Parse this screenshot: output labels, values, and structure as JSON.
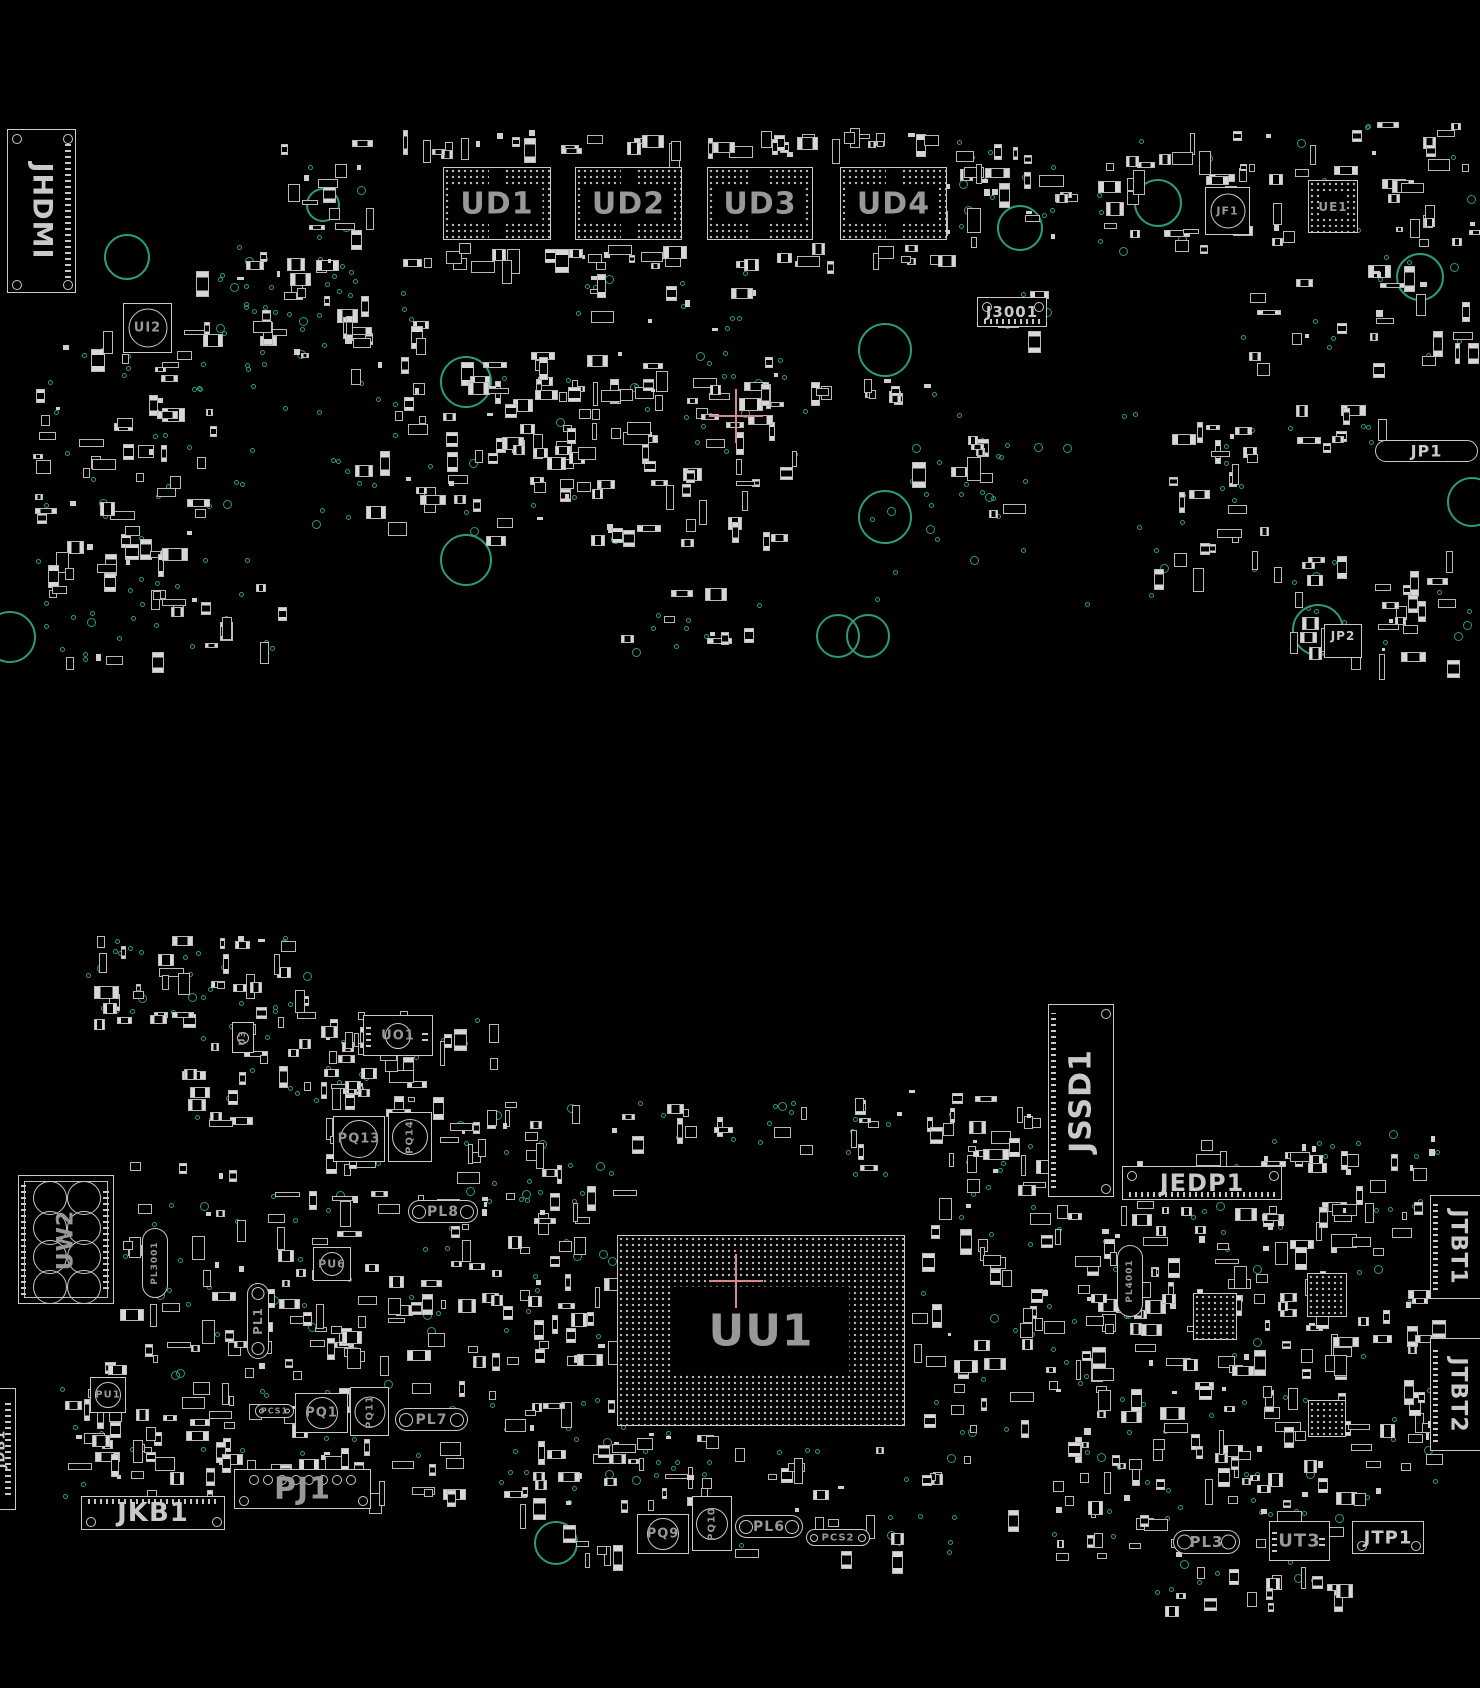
{
  "colors": {
    "background": "#000000",
    "component_outline": "#c9c9c9",
    "label_gray": "#989898",
    "label_bright": "#c9c9c9",
    "via_teal": "#2b9c78",
    "mounting_hole_teal": "#2b9c78",
    "crosshair_red": "#d48a8a",
    "bga_dot": "#b3b3b3"
  },
  "components": [
    {
      "label": "JHDMI",
      "x": 7,
      "y": 129,
      "w": 69,
      "h": 164,
      "kind": "connector",
      "rot": 90,
      "fs": 27,
      "corners": [
        "tl",
        "tr",
        "bl",
        "br"
      ],
      "pins": "right",
      "bright": true
    },
    {
      "label": "UD1",
      "x": 443,
      "y": 167,
      "w": 108,
      "h": 73,
      "kind": "bga",
      "fs": 30
    },
    {
      "label": "UD2",
      "x": 575,
      "y": 167,
      "w": 107,
      "h": 73,
      "kind": "bga",
      "fs": 30
    },
    {
      "label": "UD3",
      "x": 707,
      "y": 167,
      "w": 106,
      "h": 73,
      "kind": "bga",
      "fs": 30
    },
    {
      "label": "UD4",
      "x": 840,
      "y": 167,
      "w": 107,
      "h": 73,
      "kind": "bga",
      "fs": 30
    },
    {
      "label": "UI2",
      "x": 123,
      "y": 303,
      "w": 49,
      "h": 50,
      "kind": "chip-circle",
      "fs": 13
    },
    {
      "label": "J3001",
      "x": 977,
      "y": 297,
      "w": 70,
      "h": 30,
      "kind": "connector",
      "fs": 15,
      "corners": [
        "tl",
        "tr"
      ],
      "pins": "bottom",
      "bright": true
    },
    {
      "label": "JF1",
      "x": 1205,
      "y": 187,
      "w": 45,
      "h": 48,
      "kind": "chip-circle",
      "fs": 11
    },
    {
      "label": "UE1",
      "x": 1308,
      "y": 180,
      "w": 50,
      "h": 53,
      "kind": "bga-center",
      "fs": 12
    },
    {
      "label": "JP1",
      "x": 1375,
      "y": 440,
      "w": 103,
      "h": 22,
      "kind": "obround",
      "fs": 16,
      "pins": "both",
      "bright": true
    },
    {
      "label": "JP2",
      "x": 1324,
      "y": 624,
      "w": 38,
      "h": 34,
      "kind": "rect",
      "fs": 12,
      "bright": true
    },
    {
      "label": "JSSD1",
      "x": 1048,
      "y": 1004,
      "w": 66,
      "h": 193,
      "kind": "connector",
      "rot": -90,
      "fs": 30,
      "corners": [
        "tr",
        "br"
      ],
      "pins": "left",
      "bright": true
    },
    {
      "label": "JEDP1",
      "x": 1122,
      "y": 1166,
      "w": 160,
      "h": 34,
      "kind": "connector",
      "fs": 24,
      "corners": [
        "tl",
        "tr"
      ],
      "pins": "bottom",
      "bright": true
    },
    {
      "label": "JTBT1",
      "x": 1430,
      "y": 1195,
      "w": 56,
      "h": 104,
      "kind": "connector",
      "rot": 90,
      "fs": 22,
      "pins": "left",
      "bright": true
    },
    {
      "label": "JTBT2",
      "x": 1430,
      "y": 1338,
      "w": 56,
      "h": 113,
      "kind": "connector",
      "rot": 90,
      "fs": 22,
      "pins": "left",
      "bright": true
    },
    {
      "label": "UU1",
      "x": 617,
      "y": 1235,
      "w": 288,
      "h": 191,
      "kind": "bga-center",
      "fs": 44,
      "cw": 0.62,
      "ch": 0.47
    },
    {
      "label": "UW2",
      "x": 18,
      "y": 1175,
      "w": 96,
      "h": 129,
      "kind": "bga-coils",
      "rot": -90,
      "fs": 22
    },
    {
      "label": "UO1",
      "x": 363,
      "y": 1015,
      "w": 70,
      "h": 41,
      "kind": "chip-pads",
      "fs": 13
    },
    {
      "label": "U3",
      "x": 232,
      "y": 1022,
      "w": 22,
      "h": 31,
      "kind": "chip-circle",
      "rot": -90,
      "fs": 9
    },
    {
      "label": "PQ13",
      "x": 333,
      "y": 1116,
      "w": 52,
      "h": 46,
      "kind": "coil",
      "fs": 13
    },
    {
      "label": "PQ14",
      "x": 388,
      "y": 1112,
      "w": 44,
      "h": 50,
      "kind": "coil",
      "rot": -90,
      "fs": 10
    },
    {
      "label": "PL3001",
      "x": 142,
      "y": 1228,
      "w": 26,
      "h": 70,
      "kind": "obround",
      "rot": -90,
      "fs": 9
    },
    {
      "label": "PL4001",
      "x": 1117,
      "y": 1245,
      "w": 26,
      "h": 72,
      "kind": "obround",
      "rot": -90,
      "fs": 9
    },
    {
      "label": "PU6",
      "x": 313,
      "y": 1247,
      "w": 38,
      "h": 34,
      "kind": "chip-circle",
      "fs": 11
    },
    {
      "label": "PL8",
      "x": 408,
      "y": 1200,
      "w": 70,
      "h": 23,
      "kind": "obround",
      "fs": 14,
      "endcircles": true
    },
    {
      "label": "PL1",
      "x": 247,
      "y": 1283,
      "w": 22,
      "h": 76,
      "kind": "obround",
      "rot": -90,
      "fs": 12,
      "endcircles": true
    },
    {
      "label": "PU1",
      "x": 90,
      "y": 1377,
      "w": 36,
      "h": 36,
      "kind": "chip-circle",
      "fs": 10
    },
    {
      "label": "PQ1",
      "x": 295,
      "y": 1393,
      "w": 53,
      "h": 40,
      "kind": "coil",
      "fs": 13
    },
    {
      "label": "PQ11",
      "x": 350,
      "y": 1387,
      "w": 39,
      "h": 49,
      "kind": "coil",
      "rot": -90,
      "fs": 10
    },
    {
      "label": "PCS1",
      "x": 255,
      "y": 1404,
      "w": 39,
      "h": 14,
      "kind": "obround",
      "fs": 8,
      "endcircles": true
    },
    {
      "label": "PL7",
      "x": 395,
      "y": 1408,
      "w": 73,
      "h": 23,
      "kind": "obround",
      "fs": 14,
      "endcircles": true
    },
    {
      "label": "JKB1",
      "x": 81,
      "y": 1496,
      "w": 144,
      "h": 34,
      "kind": "connector",
      "fs": 26,
      "corners": [
        "bl",
        "br"
      ],
      "pins": "top",
      "bright": true
    },
    {
      "label": "PJ1",
      "x": 234,
      "y": 1469,
      "w": 137,
      "h": 40,
      "kind": "connector-pj",
      "fs": 30
    },
    {
      "label": "JDB1",
      "x": -14,
      "y": 1388,
      "w": 30,
      "h": 122,
      "kind": "connector",
      "rot": -90,
      "fs": 13,
      "pins": "right",
      "bright": true
    },
    {
      "label": "PQ9",
      "x": 637,
      "y": 1514,
      "w": 52,
      "h": 40,
      "kind": "coil",
      "fs": 13
    },
    {
      "label": "PQ10",
      "x": 692,
      "y": 1496,
      "w": 40,
      "h": 55,
      "kind": "coil",
      "rot": -90,
      "fs": 10
    },
    {
      "label": "PL6",
      "x": 735,
      "y": 1515,
      "w": 68,
      "h": 23,
      "kind": "obround",
      "fs": 14,
      "endcircles": true
    },
    {
      "label": "PCS2",
      "x": 806,
      "y": 1529,
      "w": 64,
      "h": 17,
      "kind": "obround",
      "fs": 10,
      "endcircles": true
    },
    {
      "label": "PL3",
      "x": 1173,
      "y": 1530,
      "w": 67,
      "h": 24,
      "kind": "obround",
      "fs": 15,
      "endcircles": true
    },
    {
      "label": "UT3",
      "x": 1269,
      "y": 1521,
      "w": 61,
      "h": 40,
      "kind": "chip-h",
      "fs": 18
    },
    {
      "label": "JTP1",
      "x": 1352,
      "y": 1521,
      "w": 72,
      "h": 33,
      "kind": "connector",
      "fs": 18,
      "corners": [
        "bl",
        "br"
      ],
      "bright": true
    },
    {
      "label": "",
      "x": 1307,
      "y": 1273,
      "w": 40,
      "h": 44,
      "kind": "bga-plain"
    },
    {
      "label": "",
      "x": 1193,
      "y": 1293,
      "w": 44,
      "h": 47,
      "kind": "bga-plain"
    },
    {
      "label": "",
      "x": 1308,
      "y": 1400,
      "w": 38,
      "h": 37,
      "kind": "bga-plain"
    }
  ],
  "mounting_holes": [
    [
      127,
      257,
      23
    ],
    [
      323,
      205,
      17
    ],
    [
      466,
      382,
      26
    ],
    [
      466,
      560,
      26
    ],
    [
      885,
      350,
      27
    ],
    [
      885,
      517,
      27
    ],
    [
      838,
      636,
      22
    ],
    [
      868,
      636,
      22
    ],
    [
      1020,
      228,
      23
    ],
    [
      1158,
      203,
      24
    ],
    [
      1420,
      277,
      24
    ],
    [
      1472,
      502,
      25
    ],
    [
      1318,
      630,
      26
    ],
    [
      10,
      637,
      26
    ],
    [
      556,
      1543,
      22
    ]
  ],
  "crosshairs": [
    [
      736,
      416
    ],
    [
      736,
      1281
    ]
  ],
  "scatter_regions": [
    [
      30,
      300,
      180,
      260,
      60,
      25
    ],
    [
      40,
      560,
      120,
      100,
      12,
      15
    ],
    [
      230,
      140,
      140,
      200,
      30,
      12
    ],
    [
      195,
      255,
      165,
      100,
      10,
      22
    ],
    [
      340,
      290,
      90,
      240,
      25,
      10
    ],
    [
      400,
      128,
      540,
      24,
      40,
      0
    ],
    [
      400,
      243,
      545,
      20,
      36,
      0
    ],
    [
      440,
      350,
      370,
      190,
      110,
      30
    ],
    [
      455,
      378,
      480,
      16,
      26,
      0
    ],
    [
      940,
      140,
      120,
      100,
      25,
      12
    ],
    [
      1090,
      130,
      180,
      120,
      30,
      10
    ],
    [
      1270,
      120,
      200,
      130,
      30,
      8
    ],
    [
      1240,
      250,
      230,
      120,
      25,
      10
    ],
    [
      1150,
      420,
      130,
      150,
      25,
      12
    ],
    [
      1285,
      405,
      95,
      40,
      8,
      4
    ],
    [
      1290,
      550,
      180,
      110,
      30,
      15
    ],
    [
      900,
      430,
      110,
      90,
      10,
      8
    ],
    [
      995,
      285,
      75,
      50,
      6,
      4
    ],
    [
      140,
      580,
      140,
      70,
      12,
      8
    ],
    [
      620,
      580,
      140,
      70,
      8,
      8
    ],
    [
      560,
      270,
      200,
      60,
      10,
      10
    ],
    [
      850,
      380,
      300,
      230,
      0,
      25
    ],
    [
      200,
      360,
      180,
      200,
      0,
      20
    ],
    [
      75,
      935,
      230,
      90,
      35,
      30
    ],
    [
      180,
      1005,
      190,
      115,
      40,
      15
    ],
    [
      320,
      1035,
      120,
      130,
      20,
      8
    ],
    [
      120,
      1160,
      115,
      200,
      25,
      10
    ],
    [
      230,
      1190,
      170,
      170,
      45,
      15
    ],
    [
      400,
      1190,
      140,
      170,
      35,
      12
    ],
    [
      440,
      1100,
      140,
      85,
      20,
      8
    ],
    [
      520,
      1180,
      95,
      180,
      25,
      10
    ],
    [
      60,
      1360,
      420,
      135,
      90,
      25
    ],
    [
      480,
      1390,
      230,
      115,
      40,
      20
    ],
    [
      910,
      1140,
      140,
      290,
      50,
      20
    ],
    [
      1050,
      1200,
      290,
      215,
      120,
      30
    ],
    [
      1050,
      1420,
      290,
      140,
      70,
      25
    ],
    [
      1340,
      1130,
      95,
      380,
      45,
      20
    ],
    [
      540,
      1440,
      480,
      115,
      35,
      20
    ],
    [
      1140,
      1560,
      200,
      50,
      15,
      8
    ],
    [
      370,
      1008,
      120,
      55,
      10,
      5
    ],
    [
      840,
      1090,
      200,
      85,
      25,
      10
    ],
    [
      585,
      1090,
      220,
      55,
      12,
      10
    ],
    [
      1130,
      1138,
      215,
      30,
      15,
      5
    ],
    [
      460,
      1140,
      150,
      60,
      0,
      12
    ]
  ]
}
